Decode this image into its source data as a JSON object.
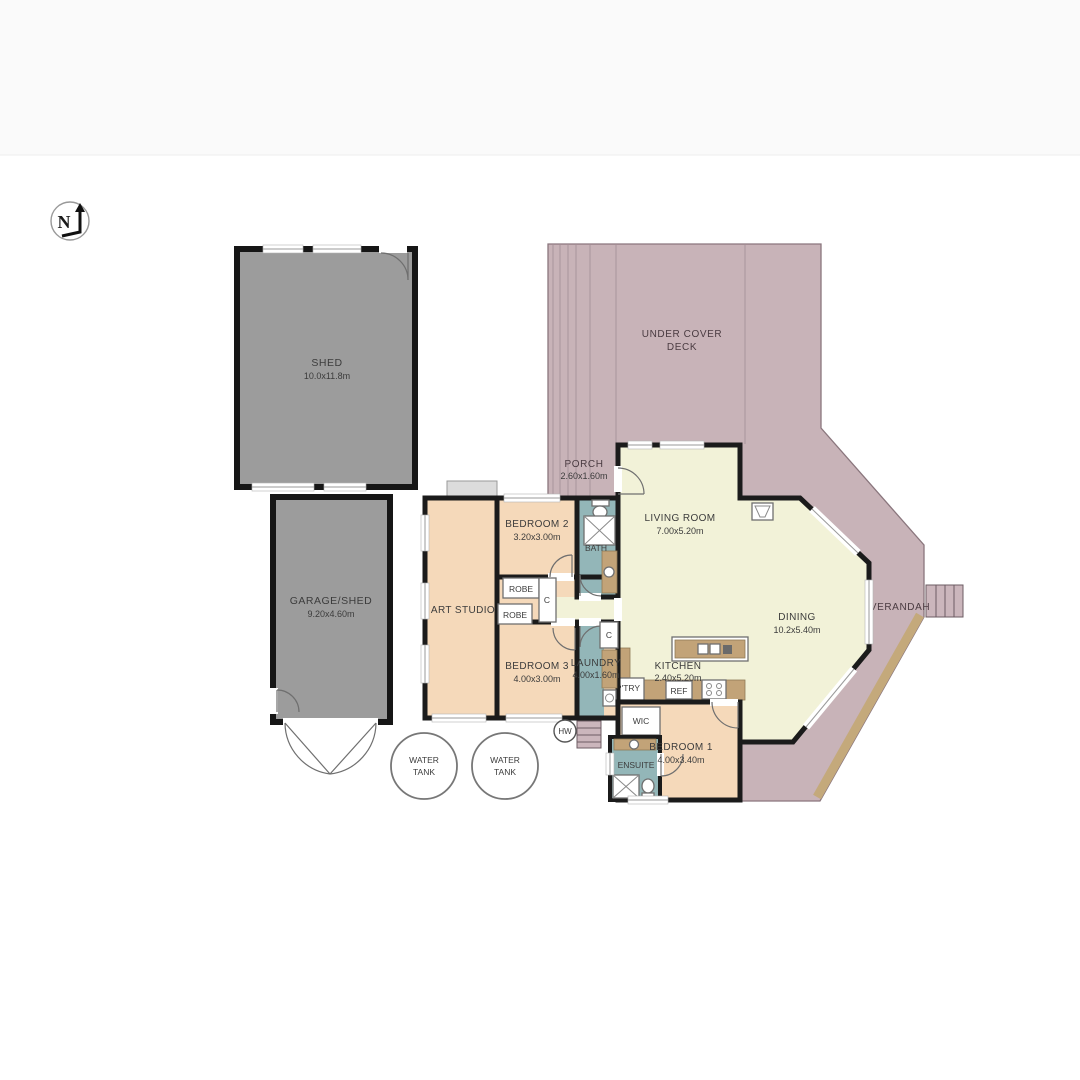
{
  "title": "Residential floor plan",
  "compass": {
    "label": "N"
  },
  "rooms": {
    "shed": {
      "name": "SHED",
      "dims": "10.0x11.8m"
    },
    "garage": {
      "name": "GARAGE/SHED",
      "dims": "9.20x4.60m"
    },
    "deck": {
      "line1": "UNDER COVER",
      "line2": "DECK"
    },
    "porch": {
      "name": "PORCH",
      "dims": "2.60x1.60m"
    },
    "living": {
      "name": "LIVING ROOM",
      "dims": "7.00x5.20m"
    },
    "dining": {
      "name": "DINING",
      "dims": "10.2x5.40m"
    },
    "kitchen": {
      "name": "KITCHEN",
      "dims": "2.40x5.20m"
    },
    "bedroom1": {
      "name": "BEDROOM 1",
      "dims": "4.00x3.40m"
    },
    "bedroom2": {
      "name": "BEDROOM 2",
      "dims": "3.20x3.00m"
    },
    "bedroom3": {
      "name": "BEDROOM 3",
      "dims": "4.00x3.00m"
    },
    "art_studio": {
      "name": "ART STUDIO"
    },
    "bath": {
      "name": "BATH"
    },
    "laundry": {
      "name": "LAUNDRY",
      "dims": "4.00x1.60m"
    },
    "ensuite": {
      "name": "ENSUITE"
    },
    "wic": {
      "name": "WIC"
    },
    "robe": {
      "name": "ROBE"
    },
    "closet": {
      "name": "C"
    },
    "pantry": {
      "name": "P'TRY"
    },
    "fridge": {
      "name": "REF"
    },
    "verandah": {
      "name": "VERANDAH"
    },
    "water_tank": {
      "line1": "WATER",
      "line2": "TANK"
    },
    "hot_water": {
      "name": "HW"
    }
  },
  "colors": {
    "wall": "#1b1b1b",
    "shed_fill": "#9c9c9c",
    "deck": "#c8b3b8",
    "floor": "#f2f2d8",
    "bedroom": "#f5d9ba",
    "wet_area": "#93b6b8",
    "bench": "#c2a378",
    "garden_path": "#c4a97b",
    "steps": "#cbb6bc",
    "background": "#ffffff"
  }
}
